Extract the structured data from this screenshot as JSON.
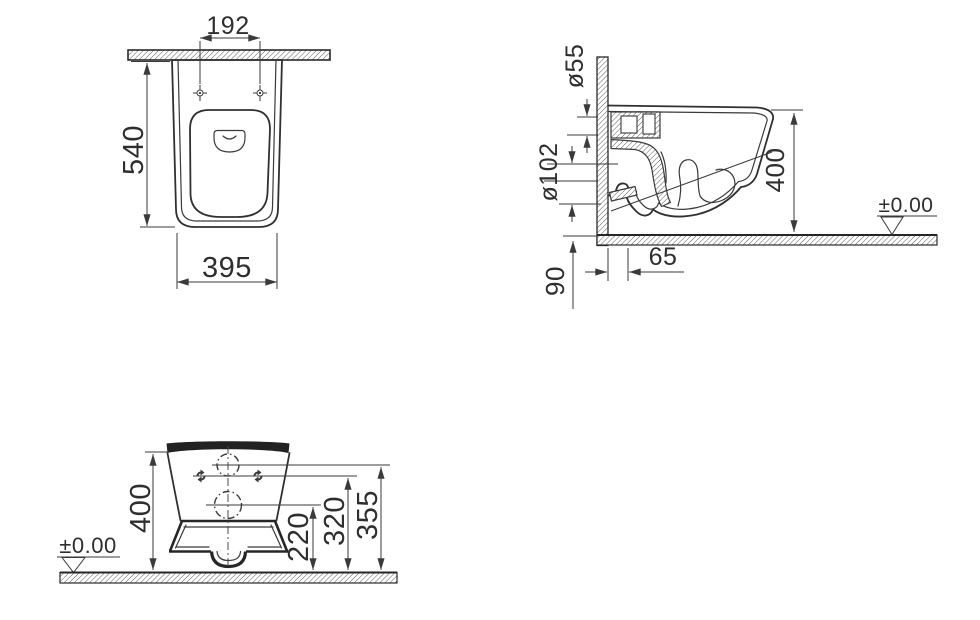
{
  "meta": {
    "background": "#ffffff",
    "ink": "#3a3a3a",
    "section_fill": "#222222"
  },
  "plan_view": {
    "dim_hole_spacing": "192",
    "dim_depth": "540",
    "dim_width": "395"
  },
  "side_view": {
    "dim_inlet_diameter": "ø55",
    "dim_outlet_diameter": "ø102",
    "dim_height": "400",
    "datum_level": "±0.00",
    "dim_outlet_offset": "65",
    "dim_outlet_distance": "90"
  },
  "rear_view": {
    "dim_height": "400",
    "datum_level": "±0.00",
    "dim_outlet_center": "220",
    "dim_fixing_line": "320",
    "dim_inlet_center": "355"
  }
}
